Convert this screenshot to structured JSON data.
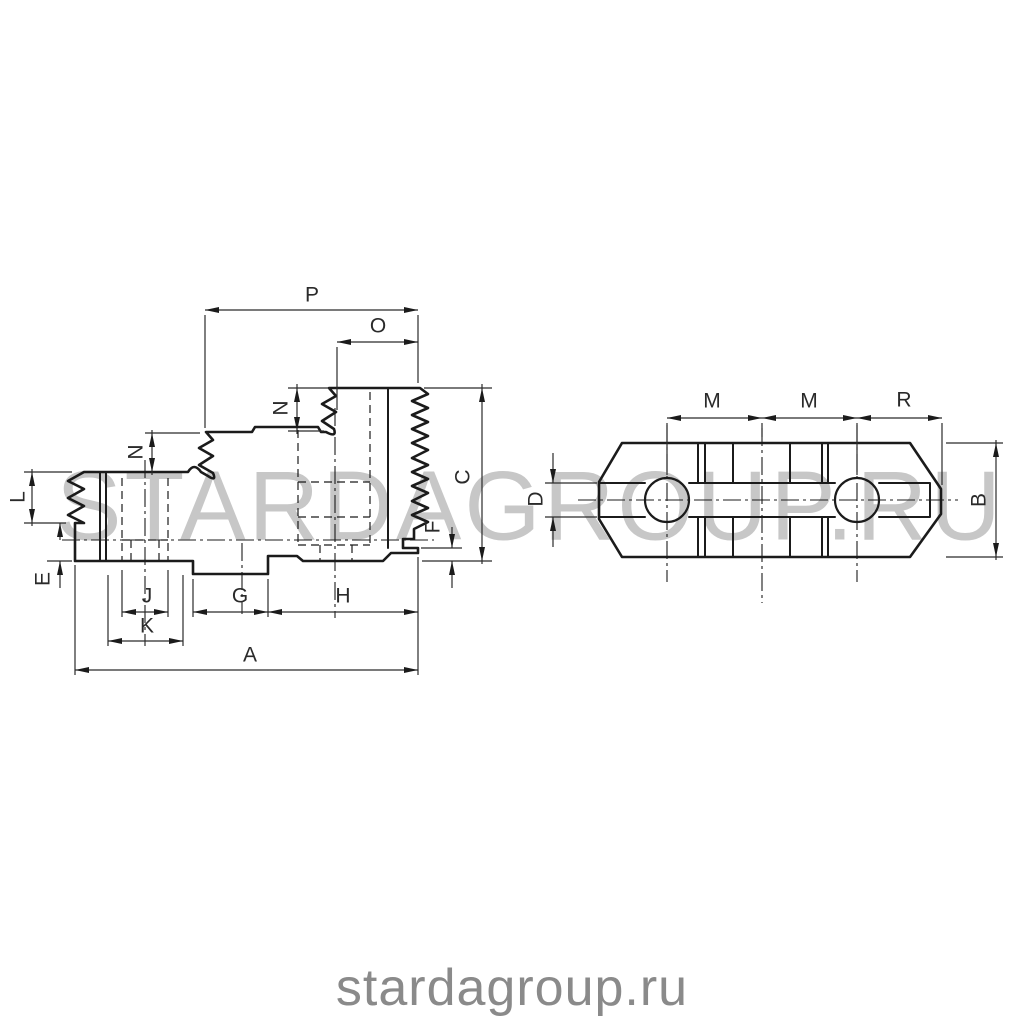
{
  "page": {
    "background": "#ffffff"
  },
  "watermark": {
    "text": "STARDAGROUP.RU",
    "color": "#c7c7c7"
  },
  "footer": {
    "text": "stardagroup.ru",
    "color": "#8a8a8a"
  },
  "drawing": {
    "description": "Technical drawing of a lathe chuck hard top jaw: serrated stepped side view (left) and plan view with two mounting holes and through slot (right)",
    "line_color": "#1b1b1b",
    "thin_line_color": "#2b2b2b",
    "views": [
      {
        "id": "side-view",
        "description": "stepped jaw profile with serrated clamping steps and serrated back face"
      },
      {
        "id": "plan-view",
        "description": "plan view: chamfered bar with two screw holes and central slot"
      }
    ],
    "dimension_labels": [
      {
        "text": "P",
        "x": 312,
        "y": 295,
        "rotated": false
      },
      {
        "text": "O",
        "x": 378,
        "y": 326,
        "rotated": false
      },
      {
        "text": "N",
        "x": 281,
        "y": 408,
        "rotated": true
      },
      {
        "text": "N",
        "x": 136,
        "y": 452,
        "rotated": true
      },
      {
        "text": "L",
        "x": 18,
        "y": 497,
        "rotated": true
      },
      {
        "text": "E",
        "x": 43,
        "y": 579,
        "rotated": true
      },
      {
        "text": "C",
        "x": 463,
        "y": 477,
        "rotated": true
      },
      {
        "text": "F",
        "x": 433,
        "y": 527,
        "rotated": true
      },
      {
        "text": "J",
        "x": 147,
        "y": 596,
        "rotated": false
      },
      {
        "text": "K",
        "x": 147,
        "y": 626,
        "rotated": false
      },
      {
        "text": "G",
        "x": 240,
        "y": 596,
        "rotated": false
      },
      {
        "text": "H",
        "x": 343,
        "y": 596,
        "rotated": false
      },
      {
        "text": "A",
        "x": 250,
        "y": 655,
        "rotated": false
      },
      {
        "text": "M",
        "x": 712,
        "y": 401,
        "rotated": false
      },
      {
        "text": "M",
        "x": 809,
        "y": 401,
        "rotated": false
      },
      {
        "text": "R",
        "x": 904,
        "y": 400,
        "rotated": false
      },
      {
        "text": "D",
        "x": 536,
        "y": 499,
        "rotated": true
      },
      {
        "text": "B",
        "x": 979,
        "y": 500,
        "rotated": true
      }
    ]
  }
}
